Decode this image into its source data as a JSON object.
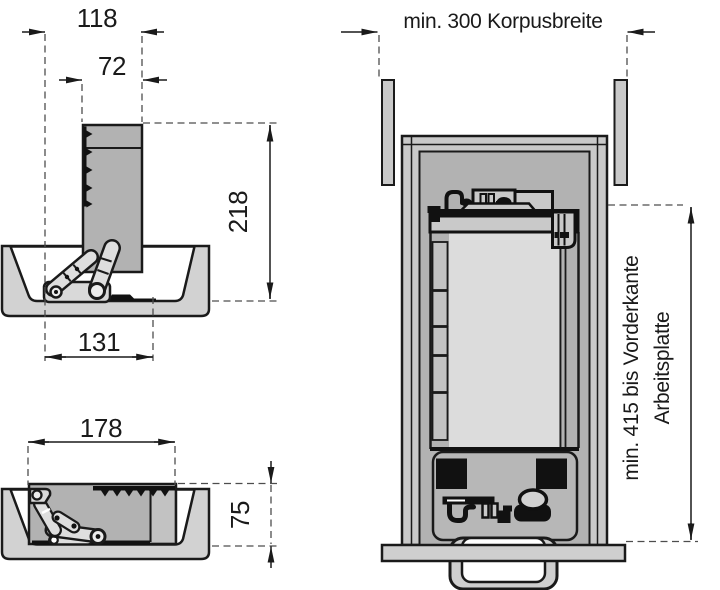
{
  "colors": {
    "background": "#ffffff",
    "outline": "#1a1a1a",
    "light_gray": "#d2d2d2",
    "mid_gray": "#b2b2b2",
    "wall_gray": "#c9c9c9",
    "inner_light": "#dcdcdc",
    "dash_gray": "#4d4d4d"
  },
  "labels": {
    "side_open": {
      "width_total": "118",
      "panel_width": "72",
      "height": "218",
      "base_length": "131"
    },
    "side_folded": {
      "length": "178",
      "height": "75"
    },
    "top_view": {
      "cabinet_width": "min. 300 Korpusbreite",
      "depth_line1": "min. 415 bis Vorderkante",
      "depth_line2": "Arbeitsplatte"
    }
  }
}
